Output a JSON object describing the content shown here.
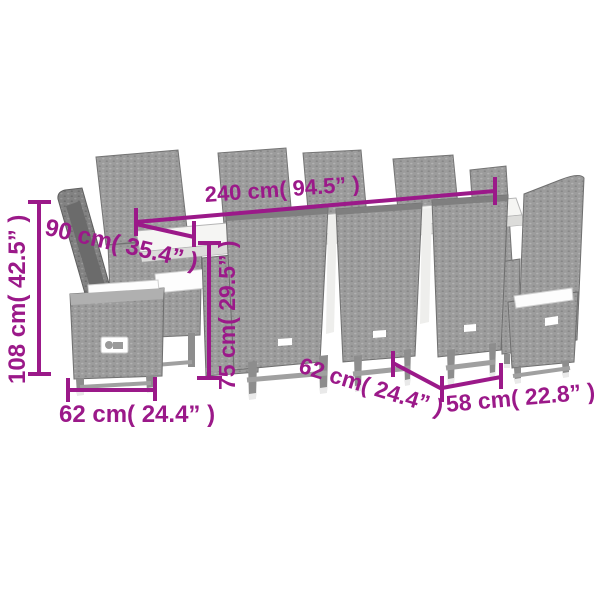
{
  "diagram": {
    "palette": {
      "accent": "#9b1989",
      "background": "#ffffff",
      "rattan_gray": "#9c9c9c",
      "rattan_dark": "#7b7b7b",
      "cushion_white": "#fdfdfd",
      "table_top": "#f5f5f3"
    },
    "dimensions": {
      "table_length": "240 cm( 94.5” )",
      "table_width": "90 cm( 35.4” )",
      "table_height": "75 cm( 29.5” )",
      "armchair_height": "108 cm( 42.5” )",
      "armchair_width": "62 cm( 24.4” )",
      "chair_depth": "62 cm( 24.4” )",
      "chair_width": "58 cm( 22.8” )"
    }
  }
}
